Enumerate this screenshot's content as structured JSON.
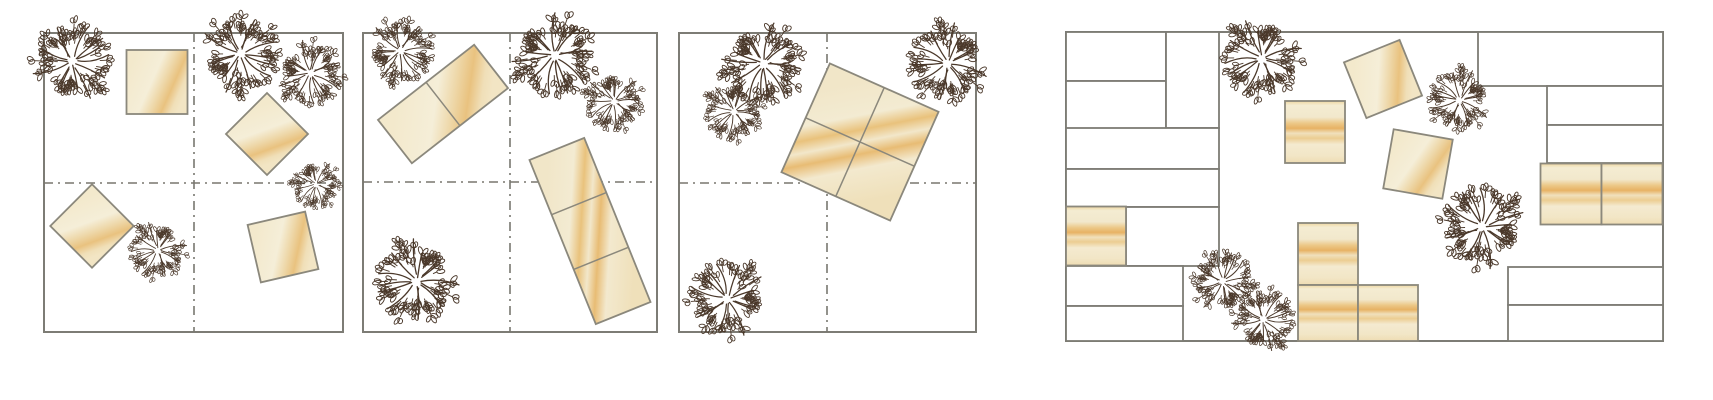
{
  "figure": {
    "kind": "architectural-site-diagrams",
    "canvas": {
      "width": 1713,
      "height": 400
    }
  },
  "palette": {
    "page_bg": "#ffffff",
    "panel_border": "#7d7c75",
    "dashed_line": "#78776f",
    "block_border": "#8b887c",
    "cell_fill": "#ffffff",
    "wood_base": "#f3e9cc",
    "wood_light": "#f5eed8",
    "wood_mid": "#eccf98",
    "wood_deep": "#e5ae5e",
    "tree": "#4a382a"
  },
  "panels": [
    {
      "id": "scheme-panel-1",
      "x": 44,
      "y": 33,
      "w": 299,
      "h": 299,
      "dashes": {
        "vx": 194,
        "hy": 183
      },
      "blocks": [
        {
          "cx": 157,
          "cy": 82,
          "w": 61,
          "h": 64,
          "rot": 0,
          "cols": 1,
          "rows": 1,
          "grain": "soft"
        },
        {
          "cx": 267,
          "cy": 134,
          "w": 58,
          "h": 58,
          "rot": 45,
          "cols": 1,
          "rows": 1,
          "grain": "soft"
        },
        {
          "cx": 92,
          "cy": 226,
          "w": 59,
          "h": 59,
          "rot": 45,
          "cols": 1,
          "rows": 1,
          "grain": "soft"
        },
        {
          "cx": 283,
          "cy": 247,
          "w": 59,
          "h": 59,
          "rot": -13,
          "cols": 1,
          "rows": 1,
          "grain": "soft"
        }
      ],
      "trees": [
        {
          "cx": 72,
          "cy": 62,
          "r": 46
        },
        {
          "cx": 240,
          "cy": 54,
          "r": 46
        },
        {
          "cx": 310,
          "cy": 73,
          "r": 38
        },
        {
          "cx": 316,
          "cy": 184,
          "r": 28
        },
        {
          "cx": 158,
          "cy": 250,
          "r": 33
        }
      ]
    },
    {
      "id": "scheme-panel-2",
      "x": 363,
      "y": 33,
      "w": 294,
      "h": 299,
      "dashes": {
        "vx": 510,
        "hy": 182
      },
      "blocks": [
        {
          "cx": 443,
          "cy": 104,
          "w": 122,
          "h": 55,
          "rot": -38,
          "cols": 2,
          "rows": 1,
          "grain": "soft"
        },
        {
          "cx": 590,
          "cy": 231,
          "w": 59,
          "h": 177,
          "rot": -22,
          "cols": 1,
          "rows": 3,
          "grain": "marble"
        }
      ],
      "trees": [
        {
          "cx": 400,
          "cy": 51,
          "r": 38
        },
        {
          "cx": 554,
          "cy": 55,
          "r": 48
        },
        {
          "cx": 614,
          "cy": 101,
          "r": 34
        },
        {
          "cx": 417,
          "cy": 281,
          "r": 48
        }
      ]
    },
    {
      "id": "scheme-panel-3",
      "x": 679,
      "y": 33,
      "w": 297,
      "h": 299,
      "dashes": {
        "vx": 827,
        "hy": 183
      },
      "blocks": [
        {
          "cx": 860,
          "cy": 142,
          "w": 119,
          "h": 119,
          "rot": 24,
          "cols": 2,
          "rows": 2,
          "grain": "marble"
        }
      ],
      "trees": [
        {
          "cx": 763,
          "cy": 63,
          "r": 47
        },
        {
          "cx": 734,
          "cy": 111,
          "r": 34
        },
        {
          "cx": 948,
          "cy": 63,
          "r": 46
        },
        {
          "cx": 728,
          "cy": 299,
          "r": 45
        }
      ]
    },
    {
      "id": "site-plan-panel",
      "x": 1066,
      "y": 32,
      "w": 597,
      "h": 309,
      "dashes": null,
      "cells": [
        {
          "x": 1066,
          "y": 32,
          "w": 100,
          "h": 49
        },
        {
          "x": 1066,
          "y": 81,
          "w": 100,
          "h": 48
        },
        {
          "x": 1166,
          "y": 32,
          "w": 53,
          "h": 96
        },
        {
          "x": 1066,
          "y": 128,
          "w": 153,
          "h": 41
        },
        {
          "x": 1066,
          "y": 169,
          "w": 153,
          "h": 38
        },
        {
          "x": 1126,
          "y": 207,
          "w": 93,
          "h": 59
        },
        {
          "x": 1066,
          "y": 266,
          "w": 117,
          "h": 40
        },
        {
          "x": 1066,
          "y": 306,
          "w": 117,
          "h": 35
        },
        {
          "x": 1478,
          "y": 32,
          "w": 185,
          "h": 54
        },
        {
          "x": 1547,
          "y": 86,
          "w": 116,
          "h": 39
        },
        {
          "x": 1547,
          "y": 125,
          "w": 116,
          "h": 38
        },
        {
          "x": 1508,
          "y": 267,
          "w": 155,
          "h": 38
        },
        {
          "x": 1508,
          "y": 305,
          "w": 155,
          "h": 36
        }
      ],
      "blocks": [
        {
          "cx": 1096,
          "cy": 236,
          "w": 60,
          "h": 59,
          "rot": 0,
          "cols": 1,
          "rows": 1,
          "grain": "bands"
        },
        {
          "cx": 1315,
          "cy": 132,
          "w": 60,
          "h": 62,
          "rot": 0,
          "cols": 1,
          "rows": 1,
          "grain": "bands"
        },
        {
          "cx": 1383,
          "cy": 79,
          "w": 60,
          "h": 60,
          "rot": -22,
          "cols": 1,
          "rows": 1,
          "grain": "soft"
        },
        {
          "cx": 1418,
          "cy": 164,
          "w": 60,
          "h": 60,
          "rot": 10,
          "cols": 1,
          "rows": 1,
          "grain": "soft"
        },
        {
          "cx": 1328,
          "cy": 254,
          "w": 60,
          "h": 62,
          "rot": 0,
          "cols": 1,
          "rows": 1,
          "grain": "bands"
        },
        {
          "cx": 1328,
          "cy": 313,
          "w": 60,
          "h": 56,
          "rot": 0,
          "cols": 1,
          "rows": 1,
          "grain": "bands"
        },
        {
          "cx": 1388,
          "cy": 313,
          "w": 60,
          "h": 56,
          "rot": 0,
          "cols": 1,
          "rows": 1,
          "grain": "bands"
        },
        {
          "cx": 1571,
          "cy": 194,
          "w": 61,
          "h": 61,
          "rot": 0,
          "cols": 1,
          "rows": 1,
          "grain": "bands"
        },
        {
          "cx": 1632,
          "cy": 194,
          "w": 61,
          "h": 61,
          "rot": 0,
          "cols": 1,
          "rows": 1,
          "grain": "bands"
        }
      ],
      "trees": [
        {
          "cx": 1262,
          "cy": 58,
          "r": 46
        },
        {
          "cx": 1460,
          "cy": 100,
          "r": 36
        },
        {
          "cx": 1483,
          "cy": 227,
          "r": 48
        },
        {
          "cx": 1223,
          "cy": 282,
          "r": 36
        },
        {
          "cx": 1263,
          "cy": 320,
          "r": 36
        }
      ]
    }
  ]
}
